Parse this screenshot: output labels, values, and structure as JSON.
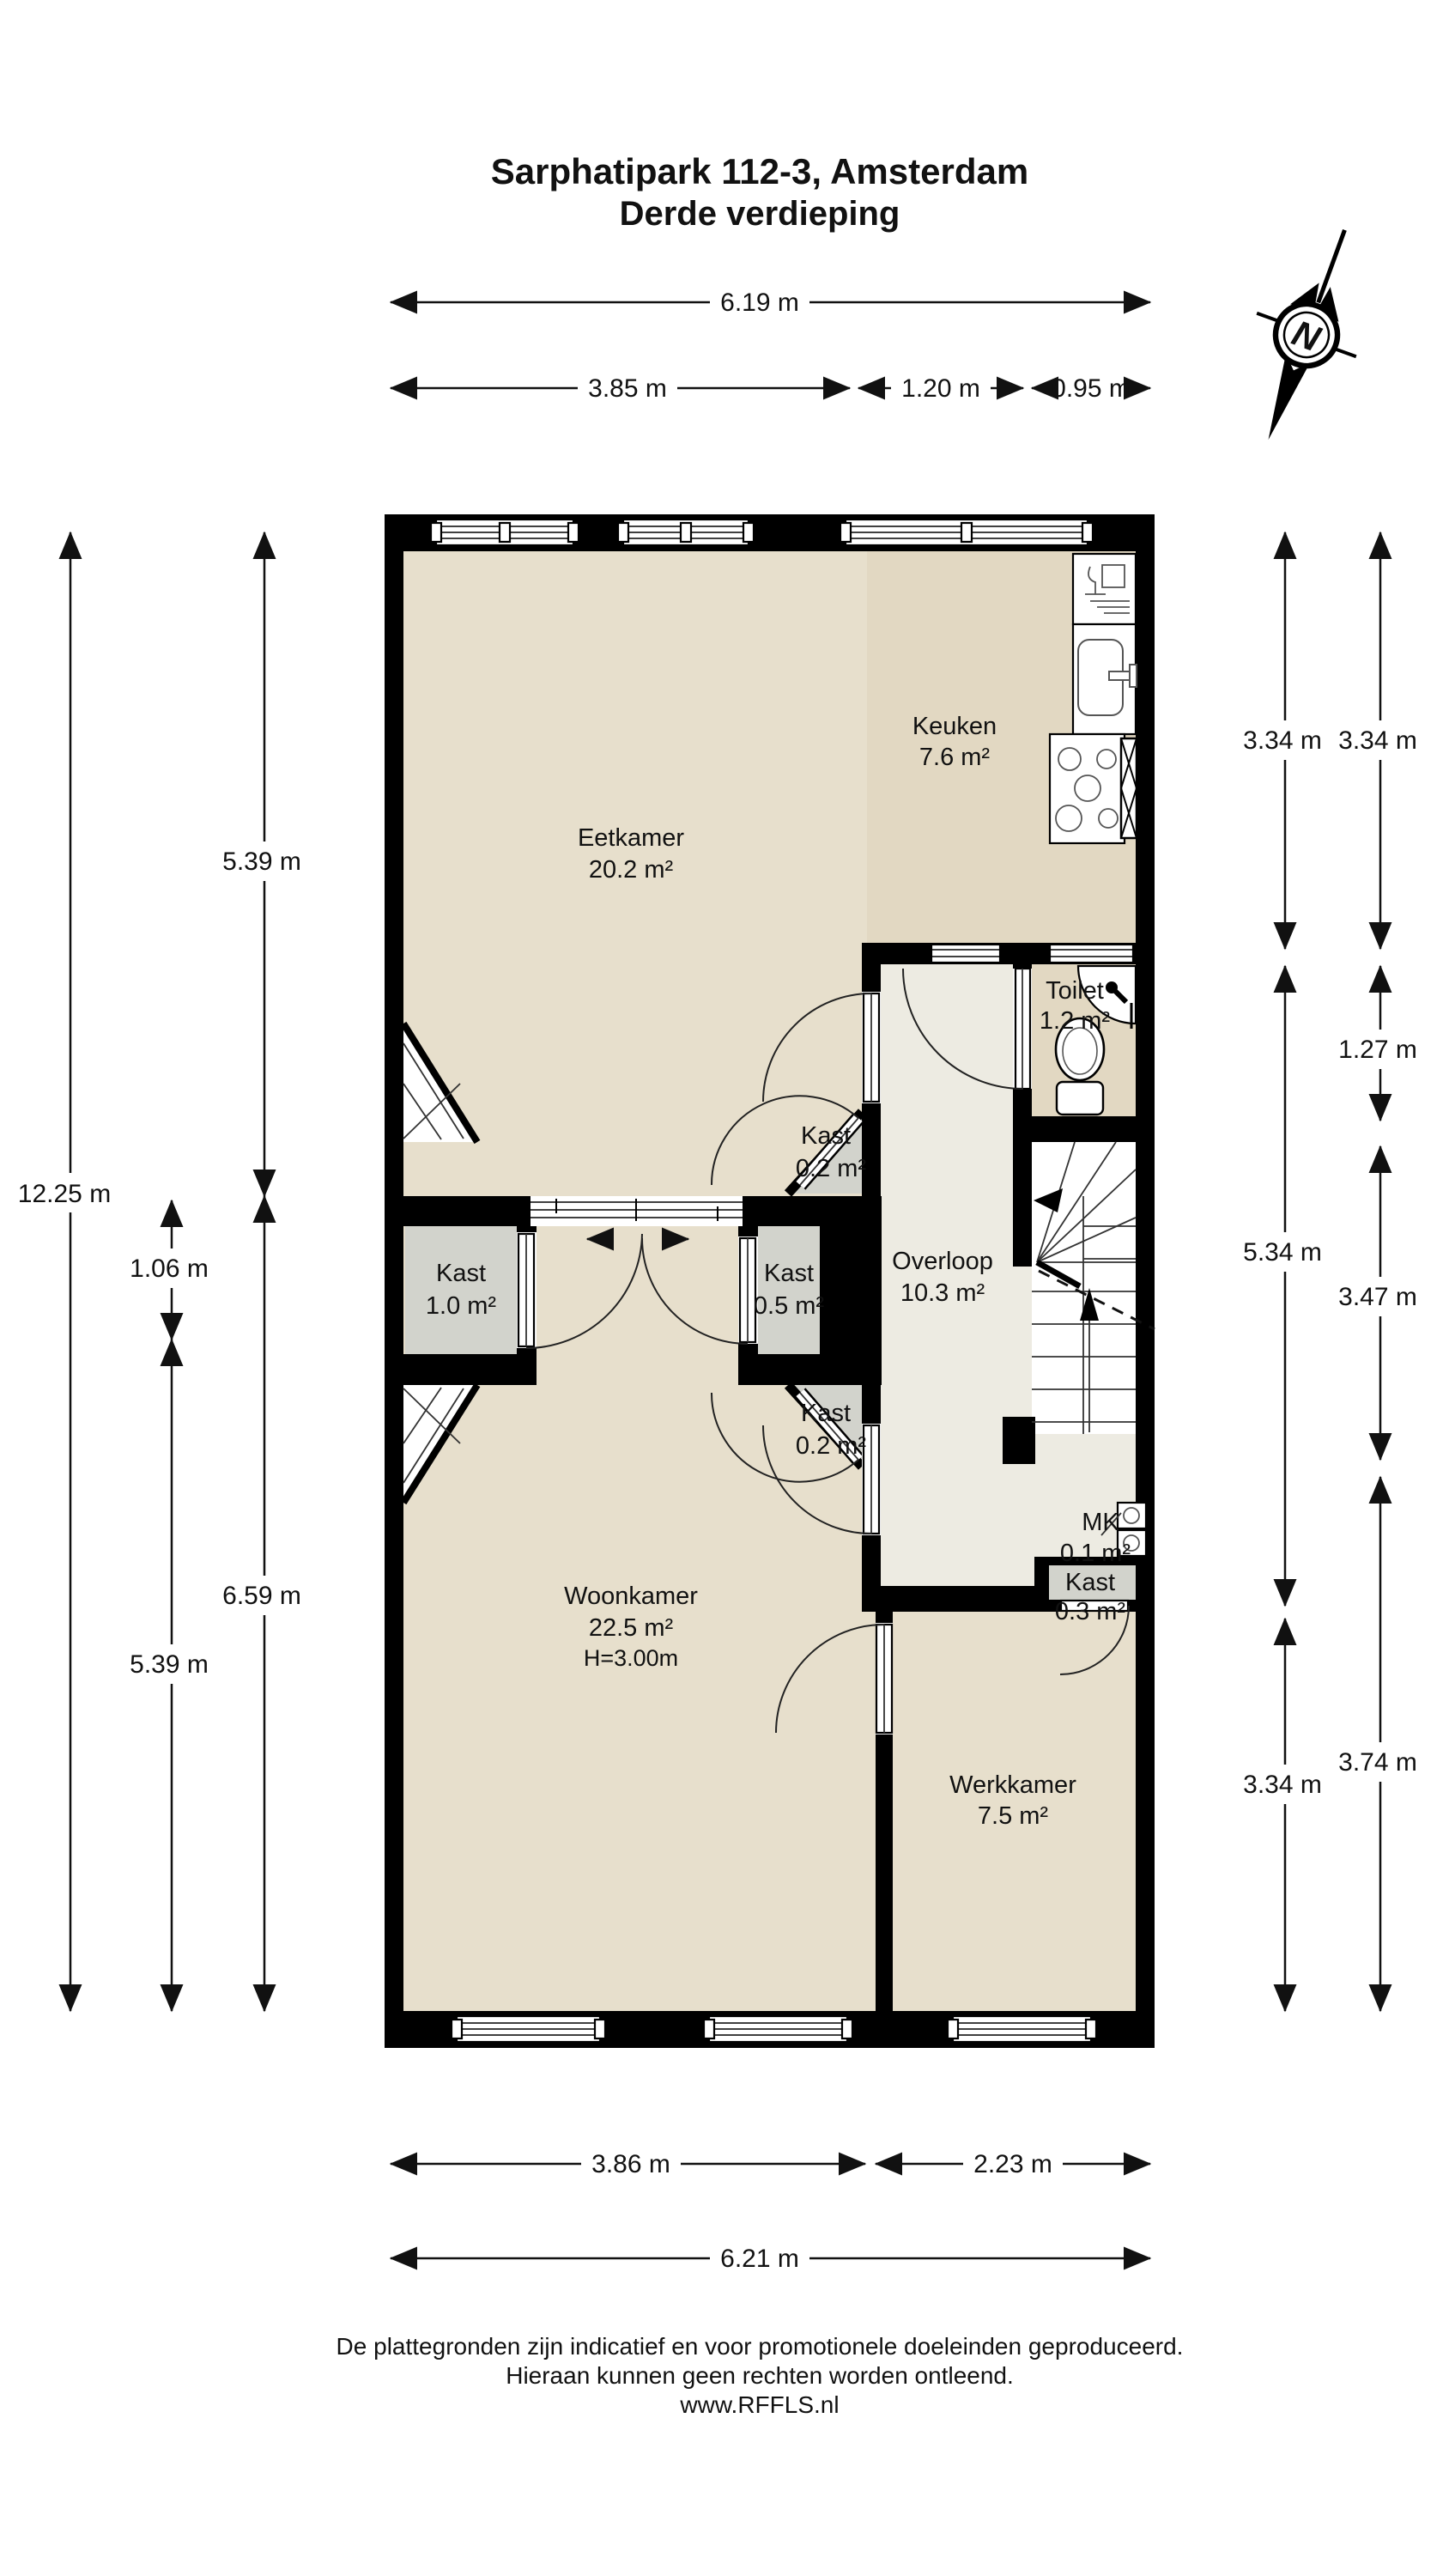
{
  "title": {
    "line1": "Sarphatipark 112-3, Amsterdam",
    "line2": "Derde verdieping"
  },
  "compass": {
    "label": "N"
  },
  "rooms": {
    "eetkamer": {
      "name": "Eetkamer",
      "area": "20.2 m²"
    },
    "keuken": {
      "name": "Keuken",
      "area": "7.6 m²"
    },
    "toilet": {
      "name": "Toilet",
      "area": "1.2 m²"
    },
    "overloop": {
      "name": "Overloop",
      "area": "10.3 m²"
    },
    "woonkamer": {
      "name": "Woonkamer",
      "area": "22.5 m²",
      "height": "H=3.00m"
    },
    "werkkamer": {
      "name": "Werkkamer",
      "area": "7.5 m²"
    },
    "kast_left": {
      "name": "Kast",
      "area": "1.0 m²"
    },
    "kast_mid": {
      "name": "Kast",
      "area": "0.5 m²"
    },
    "kast_top": {
      "name": "Kast",
      "area": "0.2 m²"
    },
    "kast_bottom": {
      "name": "Kast",
      "area": "0.2 m²"
    },
    "kast_mk": {
      "name": "Kast",
      "area": "0.3 m²"
    },
    "mk": {
      "name": "MK",
      "area": "0.1 m²"
    }
  },
  "dimensions": {
    "top": [
      "6.19 m",
      "3.85 m",
      "1.20 m",
      "0.95 m"
    ],
    "bottom": [
      "3.86 m",
      "2.23 m",
      "6.21 m"
    ],
    "left": [
      "12.25 m",
      "5.39 m",
      "1.06 m",
      "6.59 m",
      "5.39 m"
    ],
    "right": [
      "3.34 m",
      "3.34 m",
      "1.27 m",
      "5.34 m",
      "3.47 m",
      "3.34 m",
      "3.74 m"
    ]
  },
  "footer": {
    "line1": "De plattegronden zijn indicatief en voor promotionele doeleinden geproduceerd.",
    "line2": "Hieraan kunnen geen rechten worden ontleend.",
    "line3": "www.RFFLS.nl"
  },
  "colors": {
    "wall": "#000000",
    "floor_beige": "#e7dfcc",
    "floor_kitchen": "#e2d8c2",
    "floor_hall": "#edebe2",
    "floor_closet": "#d2d3cc"
  }
}
